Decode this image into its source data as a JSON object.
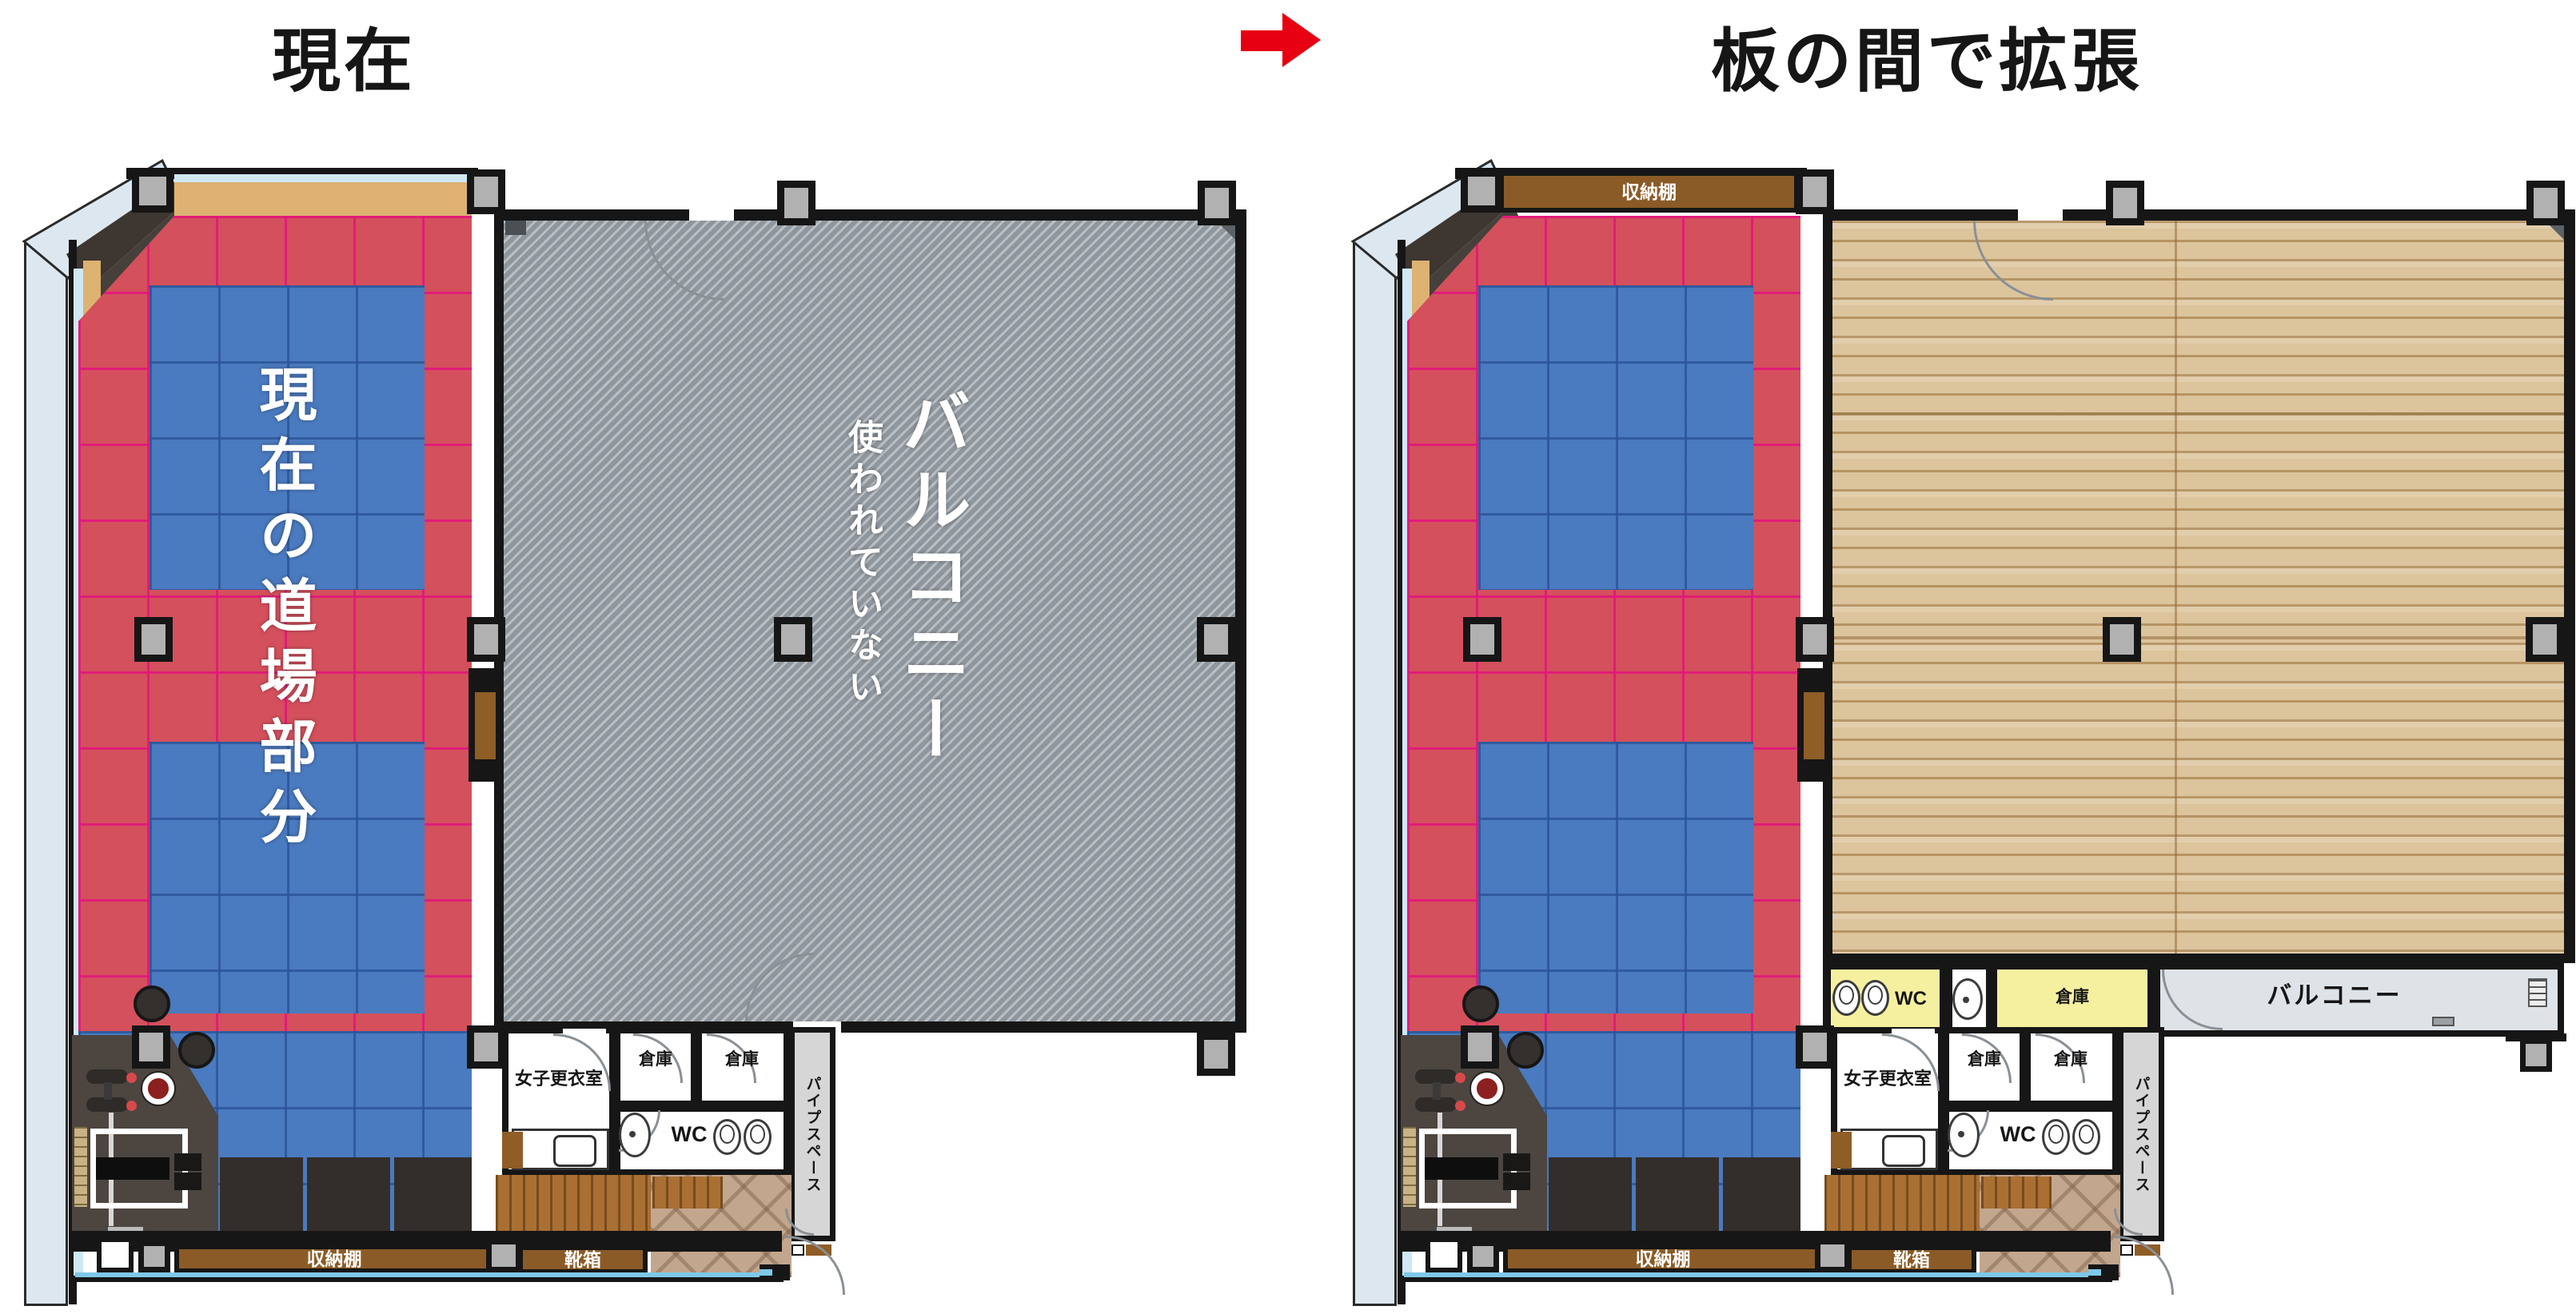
{
  "header": {
    "left_title": "現在",
    "right_title": "板の間で拡張"
  },
  "left_plan": {
    "labels": {
      "dojo": "現在の道場部分",
      "balcony": "バルコニー",
      "balcony_note": "使われていない",
      "womens_locker": "女子更衣室",
      "storage_a": "倉庫",
      "storage_b": "倉庫",
      "wc": "WC",
      "pipe_space": "パイプスペース",
      "shelf_bottom": "収納棚",
      "shoe_box": "靴箱"
    }
  },
  "right_plan": {
    "labels": {
      "shelf_top": "収納棚",
      "wc_mid": "WC",
      "storage_mid": "倉庫",
      "balcony_strip": "バルコニー",
      "womens_locker": "女子更衣室",
      "storage_a": "倉庫",
      "storage_b": "倉庫",
      "wc": "WC",
      "pipe_space": "パイプスペース",
      "shelf_bottom": "収納棚",
      "shoe_box": "靴箱"
    }
  },
  "colors": {
    "mat_red": "#D4505C",
    "mat_blue": "#4A7ABF",
    "balcony_gray": "#8F979E",
    "wood_floor": "#DCC49C",
    "room_yellow": "#F5EFA0",
    "shelf_brown": "#8A5B26",
    "arrow_red": "#E60012"
  }
}
